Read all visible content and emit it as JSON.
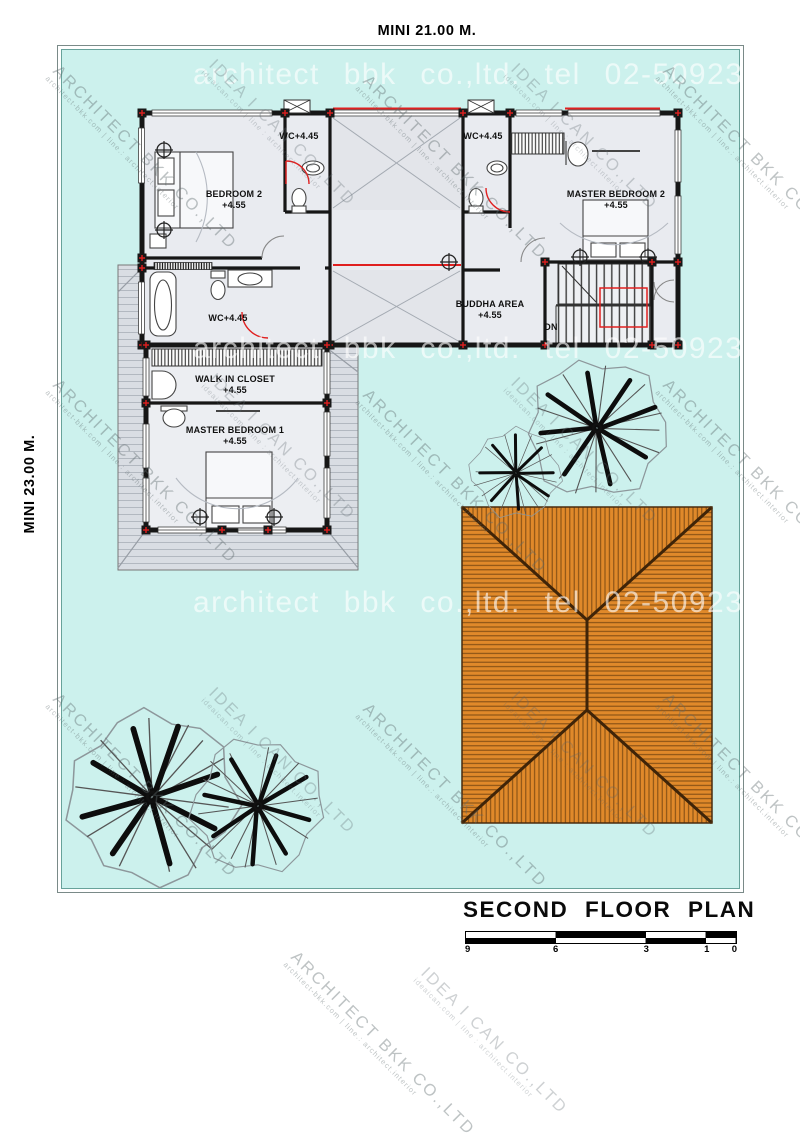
{
  "dimensions": {
    "top": "MINI 21.00 M.",
    "left": "MINI 23.00 M."
  },
  "rooms": {
    "bedroom2": {
      "name": "BEDROOM 2",
      "level": "+4.55"
    },
    "wc_top_left": {
      "name": "WC+4.45"
    },
    "wc_top_right": {
      "name": "WC+4.45"
    },
    "master_bedroom2": {
      "name": "MASTER BEDROOM 2",
      "level": "+4.55"
    },
    "wc_middle": {
      "name": "WC+4.45"
    },
    "buddha_area": {
      "name": "BUDDHA AREA",
      "level": "+4.55"
    },
    "walk_in_closet": {
      "name": "WALK IN CLOSET",
      "level": "+4.55"
    },
    "master_bedroom1": {
      "name": "MASTER BEDROOM 1",
      "level": "+4.55"
    },
    "stairs": {
      "label": "DN"
    }
  },
  "watermarks": {
    "brand_line": "architect bbk co.,ltd.  tel  02-5092324",
    "company1": "ARCHITECT BKK CO.,LTD",
    "company1_sub": "architect-bkk.com | line.: architect.interior",
    "company2": "IDEA I CAN CO.,LTD",
    "company2_sub": "ideaican.com | line : architect.interior"
  },
  "title_block": {
    "title": "SECOND FLOOR PLAN",
    "scale_marks": [
      "9",
      "6",
      "3",
      "1",
      "0"
    ]
  },
  "colors": {
    "site_fill": "#ccf1ed",
    "roof_orange": "#e0892a",
    "accent_red": "#e02020",
    "wall": "#161616",
    "deck_gray": "#d9dde3",
    "floor": "#e9ebf0"
  }
}
